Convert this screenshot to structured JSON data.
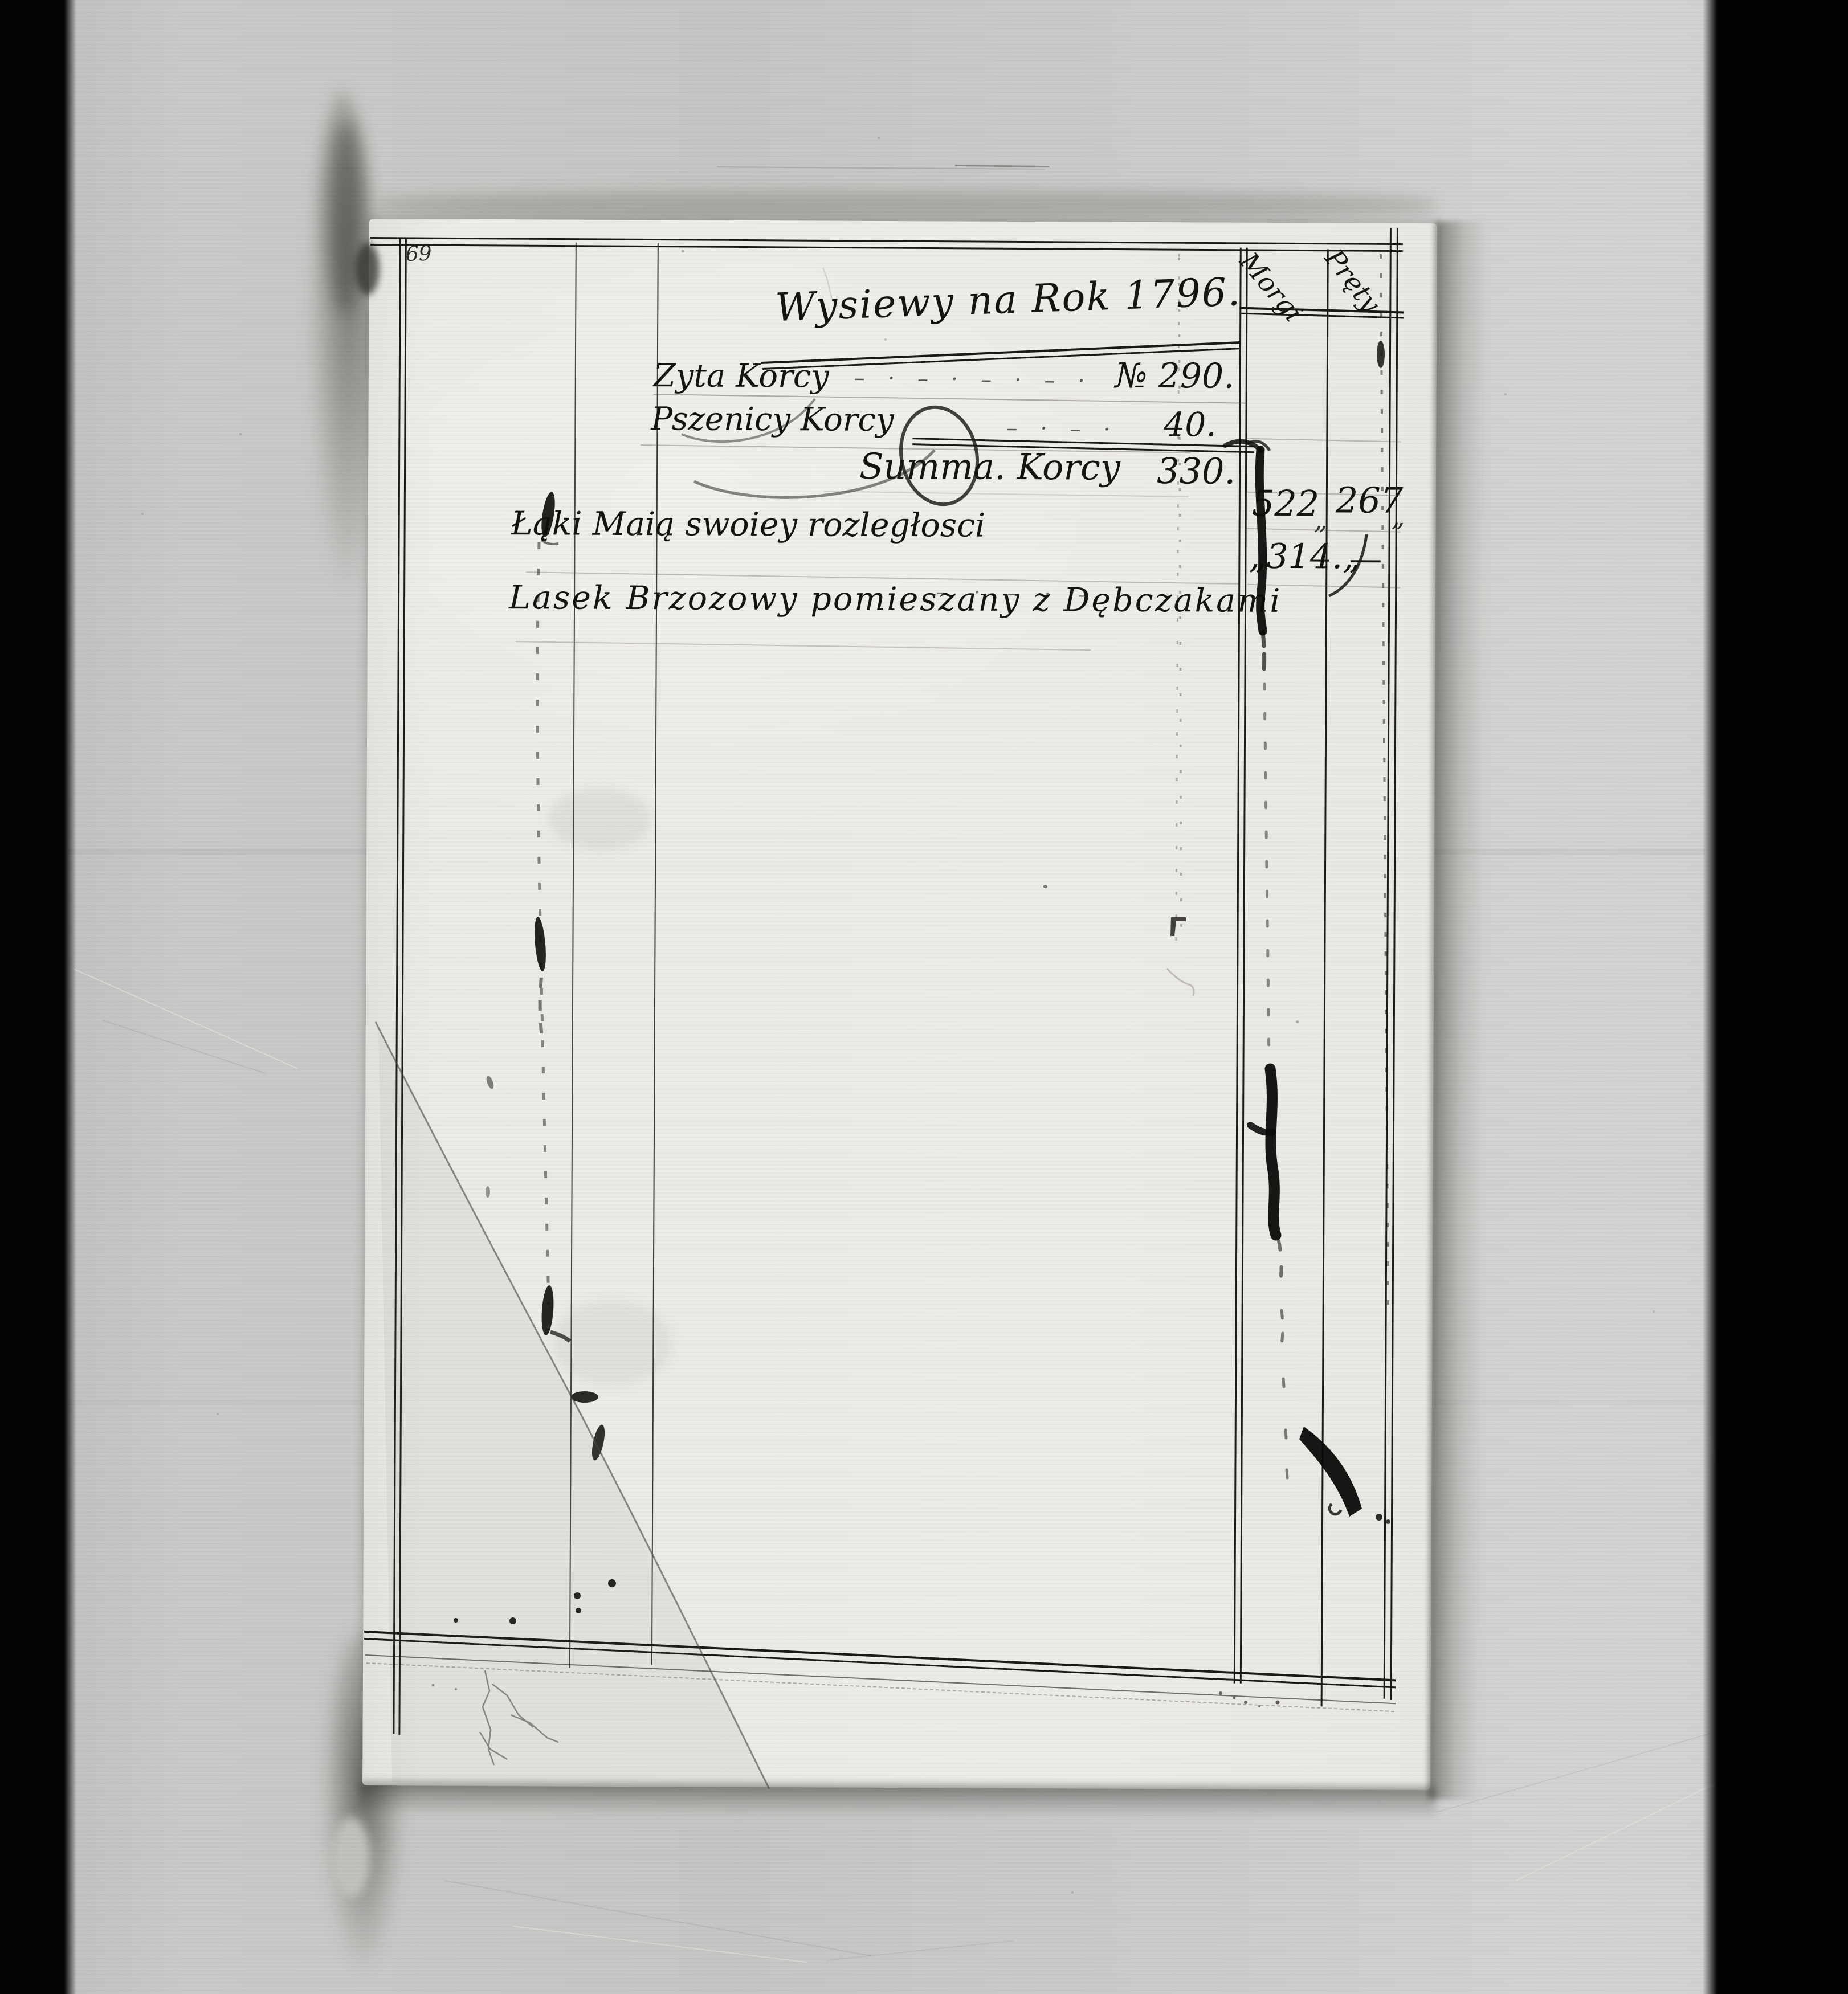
{
  "document": {
    "page_number": "69",
    "title": "Wysiewy na Rok 1796.",
    "header_columns": [
      {
        "label": "Morgi"
      },
      {
        "label": "Pręty"
      }
    ],
    "entries": [
      {
        "label": "Zyta Korcy",
        "leaders": "– · – · – · – ·",
        "value": "№ 290."
      },
      {
        "label": "Pszenicy Korcy",
        "leaders": "– · – ·",
        "value": "40."
      },
      {
        "label": "Summa. Korcy",
        "value": "330."
      },
      {
        "label": "Łąki Maią swoiey rozległosci",
        "leaders": "– · – · – ·",
        "value_morgi": "522",
        "separator": "„",
        "value_prety": "267",
        "trailing_mark": "„"
      },
      {
        "label": "Lasek Brzozowy pomieszany z Dębczakami",
        "value_morgi": "„314.„",
        "value_prety": "—"
      }
    ],
    "colors": {
      "paper": "#eceae5",
      "background": "#c9c9c7",
      "film_bar": "#060606",
      "ink": "#16140f"
    }
  }
}
